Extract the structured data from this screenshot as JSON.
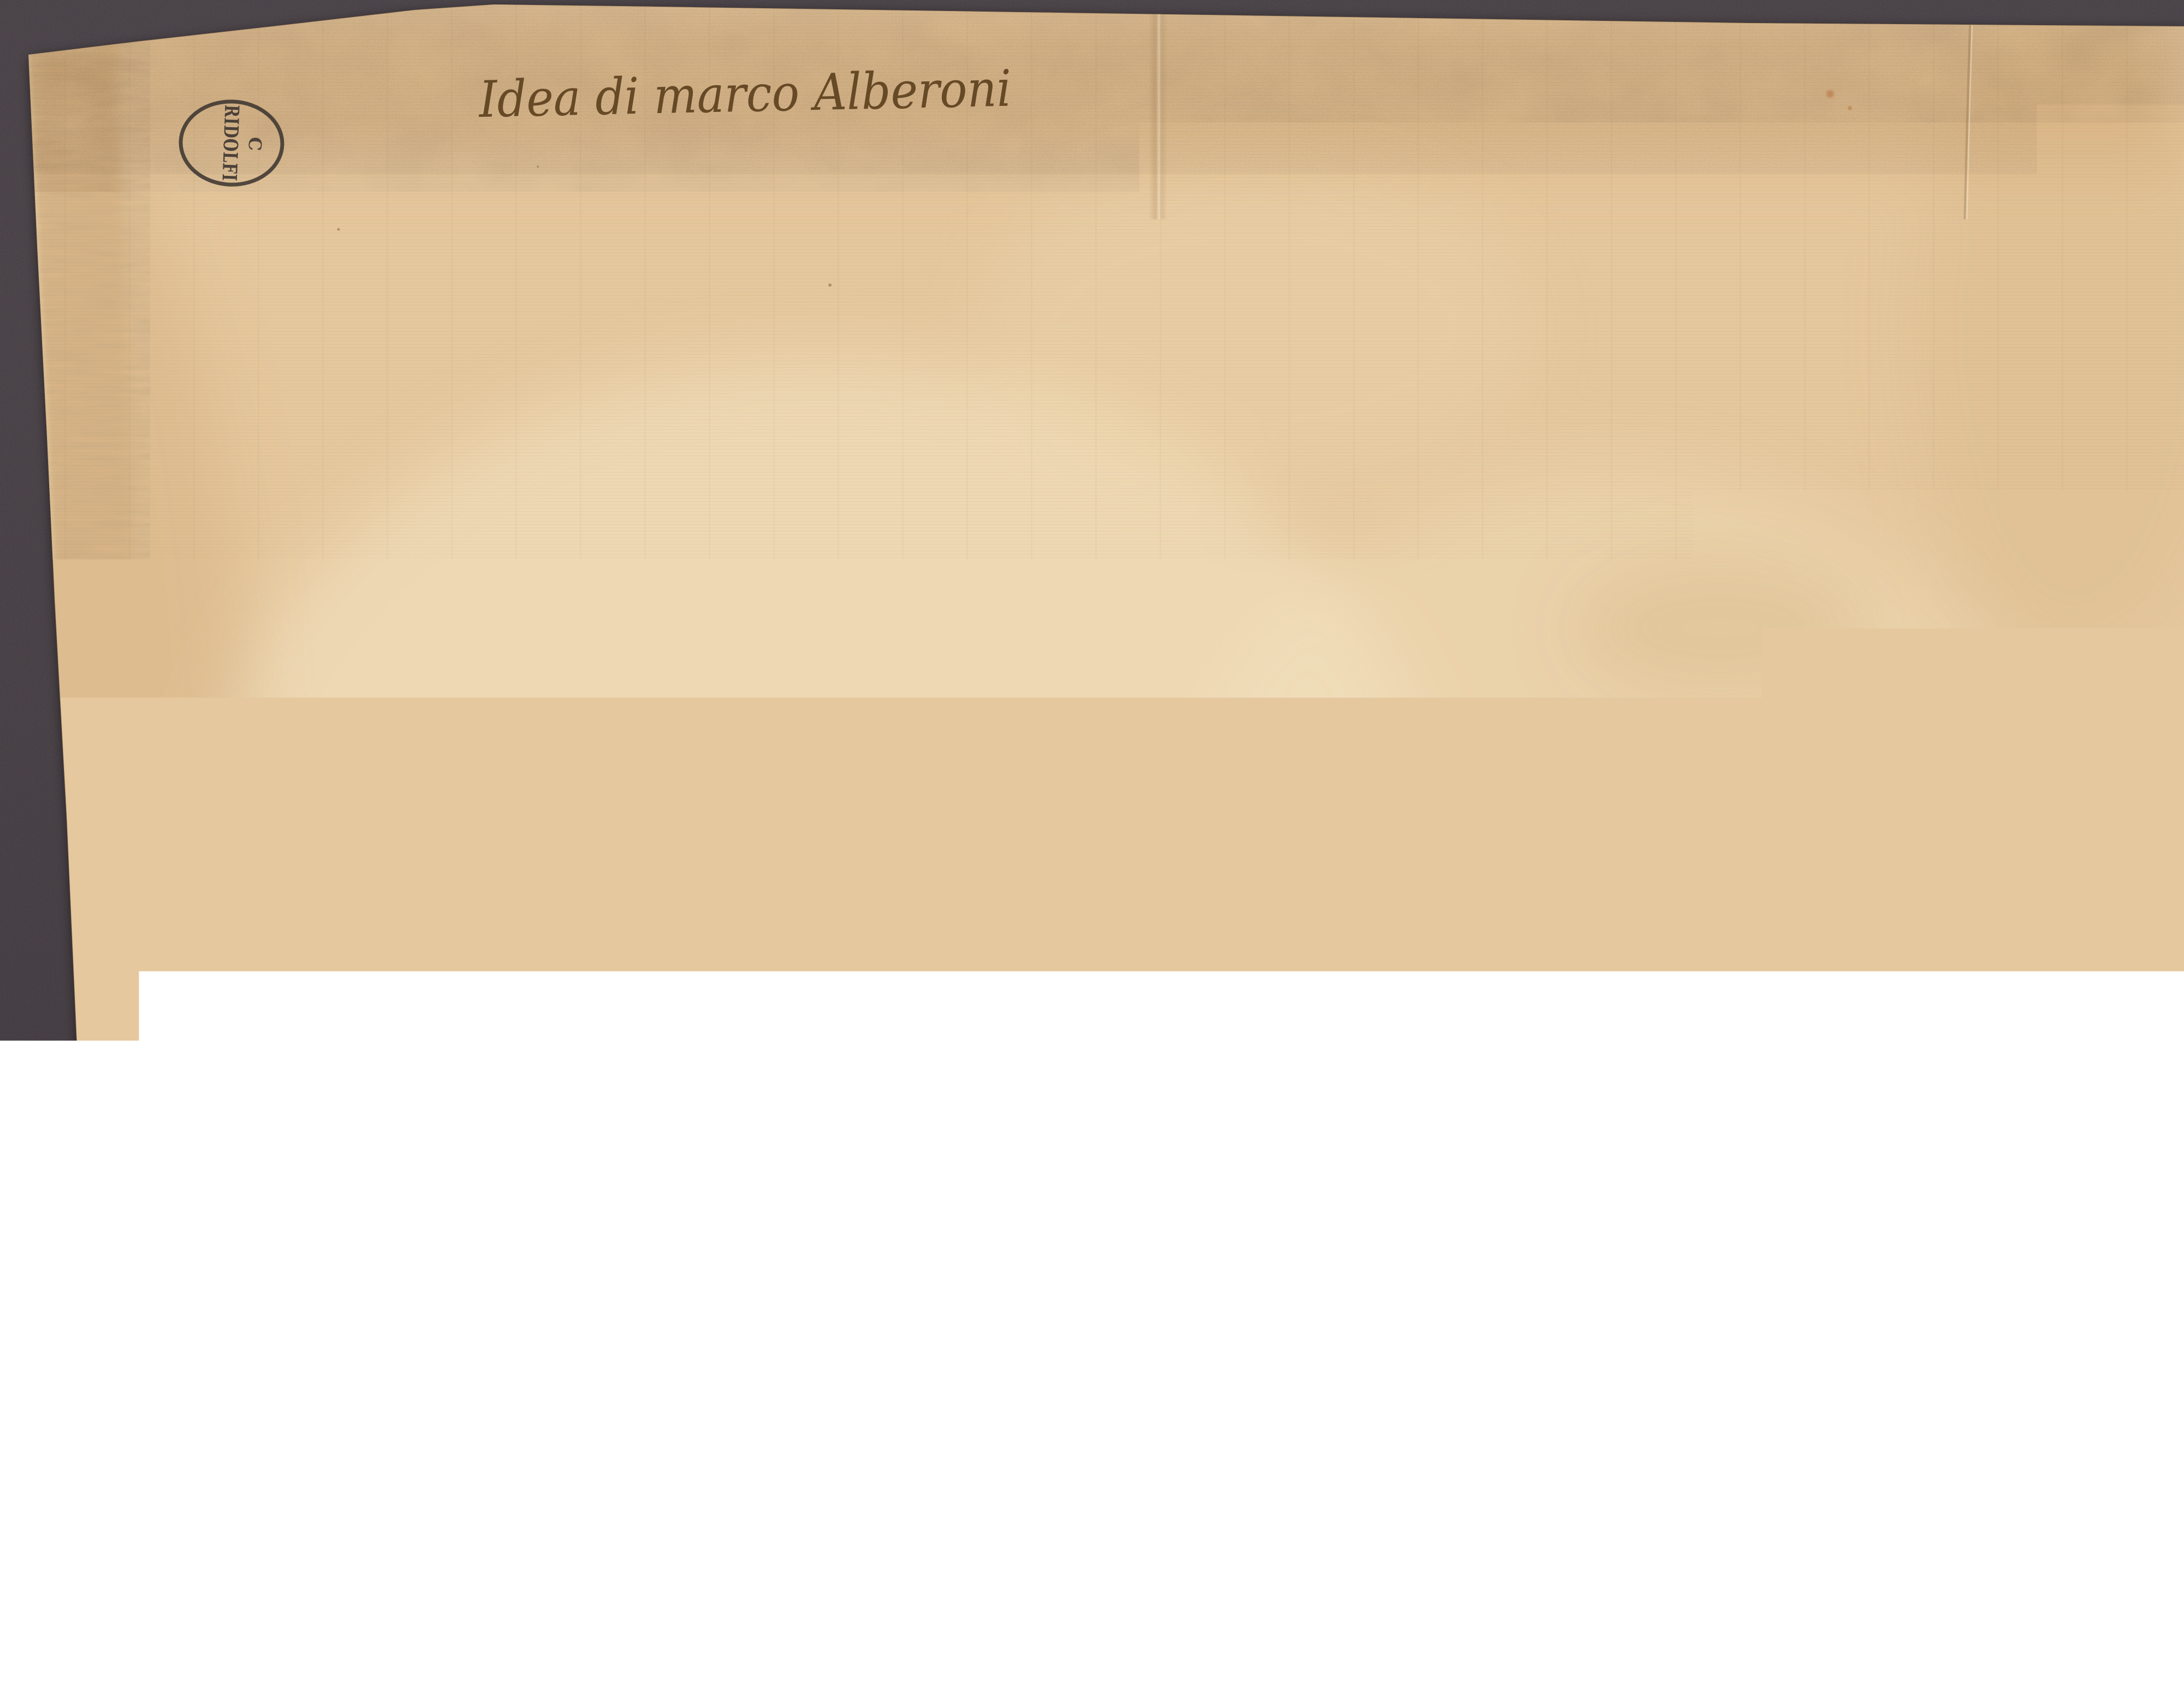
{
  "artwork": {
    "inscription": {
      "text": "Idea di marco Alberoni"
    },
    "stamp": {
      "word": "RIDOLFI",
      "initial": "C"
    },
    "pencil_marks": {
      "numeral": "2",
      "roman_numeral": "VI"
    }
  },
  "colors": {
    "mat": "#484148",
    "paper": "#e6c89e",
    "paper_band": "#d7b183",
    "ink": "#5a4630",
    "ink_light": "#8a734f",
    "inscription_ink": "#5e421f",
    "stamp_ink": "#38322e",
    "pencil": "#7b7265",
    "pencil_blue": "#5a6880",
    "stain_rust": "#b5713a",
    "stain_brown": "#9c6b33",
    "stain_olive": "#7a6b3c",
    "stain_dark": "#4a4036",
    "stain_soft": "#c49b64"
  }
}
